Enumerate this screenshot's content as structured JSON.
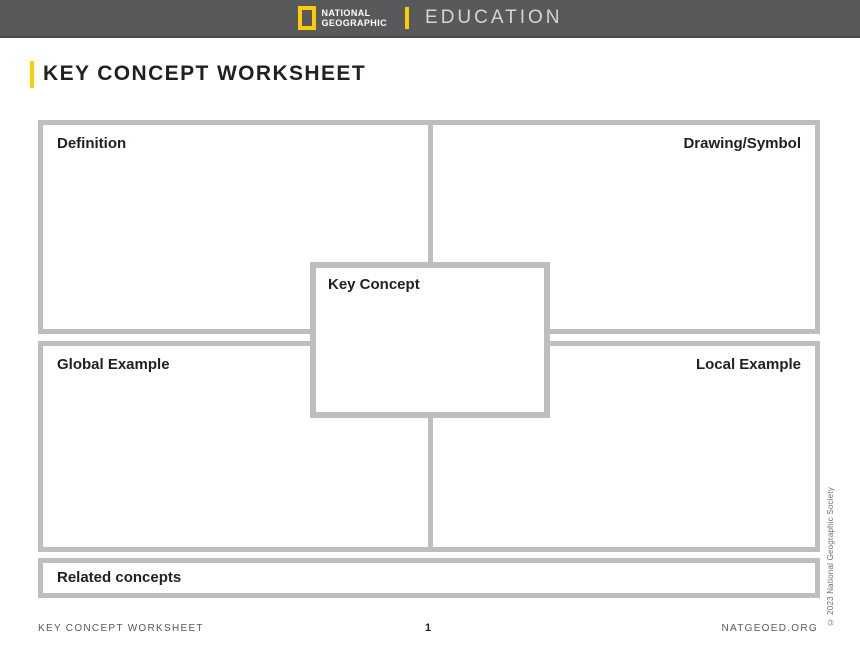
{
  "header": {
    "logo_line1": "NATIONAL",
    "logo_line2": "GEOGRAPHIC",
    "brand": "EDUCATION",
    "bar_color": "#58595B",
    "accent_color": "#FFCC00"
  },
  "page_title": "KEY CONCEPT WORKSHEET",
  "worksheet": {
    "border_color": "#BCBEC0",
    "boxes": [
      {
        "id": "definition",
        "label": "Definition",
        "label_align": "left"
      },
      {
        "id": "drawing-symbol",
        "label": "Drawing/Symbol",
        "label_align": "right"
      },
      {
        "id": "key-concept",
        "label": "Key Concept",
        "label_align": "left"
      },
      {
        "id": "global-example",
        "label": "Global Example",
        "label_align": "left"
      },
      {
        "id": "local-example",
        "label": "Local Example",
        "label_align": "right"
      },
      {
        "id": "related-concepts",
        "label": "Related concepts",
        "label_align": "left"
      }
    ]
  },
  "footer": {
    "left": "KEY CONCEPT WORKSHEET",
    "page_number": "1",
    "right": "NATGEOED.ORG"
  },
  "copyright": "© 2023 National Geographic Society"
}
